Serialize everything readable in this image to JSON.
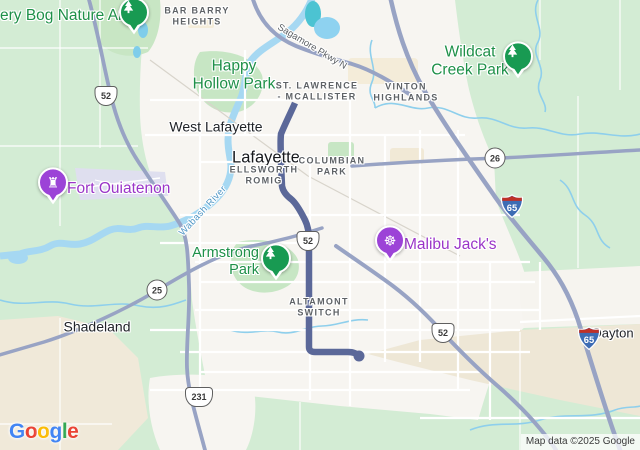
{
  "colors": {
    "route": "#5b6899",
    "highway": "#98a3c4",
    "water": "#a6d8f2",
    "nature_green": "#d3ecd4",
    "park_pin_green": "#189a52",
    "poi_purple": "#9c43d7",
    "terrain_beige": "#eee7d6"
  },
  "map": {
    "attribution": "Map data ©2025 Google",
    "labels": {
      "celery_bog": "ery Bog Nature Area",
      "bar_barry": "BAR BARRY\nHEIGHTS",
      "sagamore_pkwy": "Sagamore Pkwy N",
      "happy_hollow": "Happy\nHollow Park",
      "st_lawrence": "ST. LAWRENCE\n- MCALLISTER",
      "vinton_highlands": "VINTON\nHIGHLANDS",
      "wildcat_creek": "Wildcat\nCreek Park",
      "west_lafayette": "West Lafayette",
      "lafayette": "Lafayette",
      "ellsworth_romig": "ELLSWORTH\nROMIG",
      "columbian_park": "COLUMBIAN\nPARK",
      "fort_ouiatenon": "Fort Ouiatenon",
      "wabash_river": "Wabash River",
      "malibu_jacks": "Malibu Jack's",
      "armstrong_park": "Armstrong\nPark",
      "altamont_switch": "ALTAMONT\nSWITCH",
      "shadeland": "Shadeland",
      "dayton": "Dayton"
    },
    "shields": {
      "us52_nw": "52",
      "us52_mid": "52",
      "us52_se": "52",
      "us231": "231",
      "sr25": "25",
      "sr26": "26",
      "i65_north": "65",
      "i65_south": "65"
    },
    "pins": {
      "celery_bog_park_pin": "tree-icon",
      "wildcat_creek_park_pin": "tree-icon",
      "armstrong_park_pin": "tree-icon",
      "fort_ouiatenon_pin": "castle-icon",
      "malibu_jacks_pin": "ferris-wheel-icon"
    }
  },
  "google_logo": {
    "letters": [
      {
        "c": "G",
        "style": "color:#4285F4"
      },
      {
        "c": "o",
        "style": "color:#EA4335"
      },
      {
        "c": "o",
        "style": "color:#FBBC05"
      },
      {
        "c": "g",
        "style": "color:#4285F4"
      },
      {
        "c": "l",
        "style": "color:#34A853"
      },
      {
        "c": "e",
        "style": "color:#EA4335"
      }
    ]
  }
}
